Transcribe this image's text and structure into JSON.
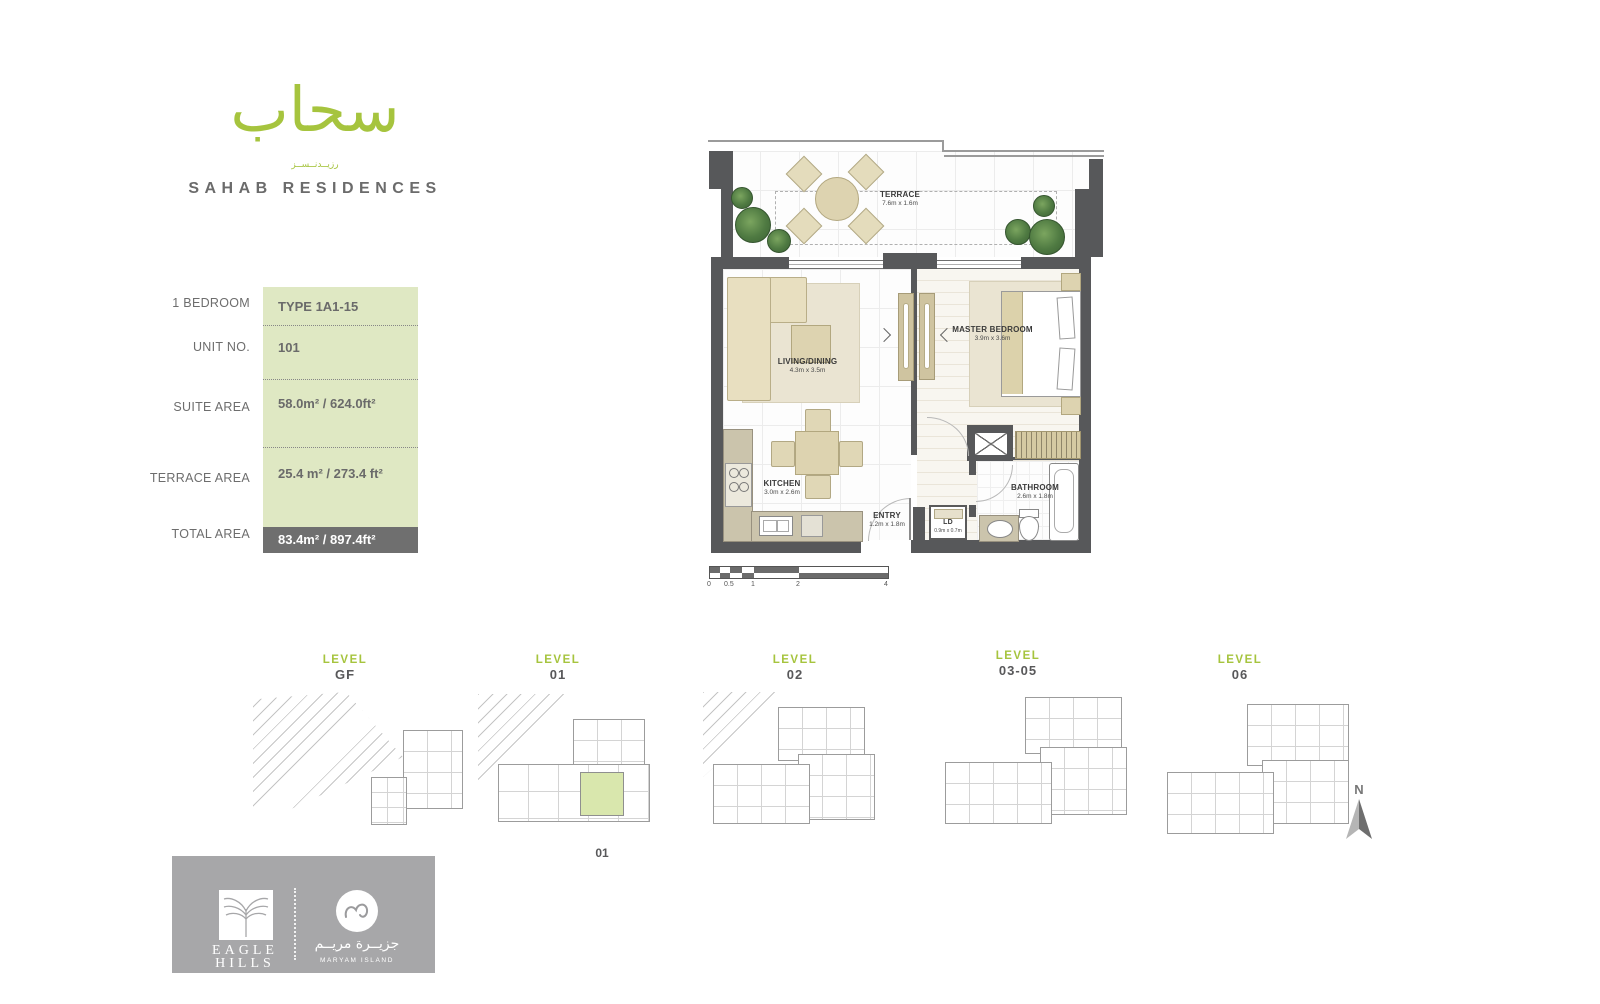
{
  "brand": {
    "arabic_logo": "سحاب",
    "arabic_sub": "رزيــدنــســز",
    "name": "SAHAB RESIDENCES"
  },
  "info_table": {
    "rows": [
      {
        "label": "1 BEDROOM",
        "value": "TYPE 1A1-15"
      },
      {
        "label": "UNIT NO.",
        "value": "101"
      },
      {
        "label": "SUITE AREA",
        "value": "58.0m² / 624.0ft²"
      },
      {
        "label": "TERRACE AREA",
        "value": "25.4 m² / 273.4 ft²"
      },
      {
        "label": "TOTAL AREA",
        "value": "83.4m² / 897.4ft²"
      }
    ]
  },
  "floor_plan": {
    "rooms": {
      "terrace": {
        "name": "TERRACE",
        "dims": "7.6m x 1.6m"
      },
      "living": {
        "name": "LIVING/DINING",
        "dims": "4.3m x 3.5m"
      },
      "master": {
        "name": "MASTER BEDROOM",
        "dims": "3.9m x 3.6m"
      },
      "kitchen": {
        "name": "KITCHEN",
        "dims": "3.0m x 2.6m"
      },
      "entry": {
        "name": "ENTRY",
        "dims": "1.2m x 1.8m"
      },
      "ld": {
        "name": "LD",
        "dims": "0.9m x 0.7m"
      },
      "bathroom": {
        "name": "BATHROOM",
        "dims": "2.6m x 1.8m"
      }
    },
    "scale_bar": {
      "labels": [
        "0",
        "0.5",
        "1",
        "2",
        "4"
      ]
    }
  },
  "levels": [
    {
      "title": "LEVEL",
      "number": "GF"
    },
    {
      "title": "LEVEL",
      "number": "01",
      "unit_label": "01"
    },
    {
      "title": "LEVEL",
      "number": "02"
    },
    {
      "title": "LEVEL",
      "number": "03-05"
    },
    {
      "title": "LEVEL",
      "number": "06"
    }
  ],
  "compass": {
    "north": "N"
  },
  "footer": {
    "eagle_line1": "EAGLE",
    "eagle_line2": "HILLS",
    "maryam_arabic": "جزيــرة مريــم",
    "maryam_en": "MARYAM ISLAND"
  },
  "colors": {
    "accent_green": "#a6c43e",
    "light_green_fill": "#dfe8c3",
    "highlight_unit_green": "#d9e7ad",
    "wall_gray": "#57585a",
    "text_gray": "#6d6d6d",
    "total_bar_gray": "#6f6f6f",
    "footer_gray": "#a7a7a9"
  }
}
